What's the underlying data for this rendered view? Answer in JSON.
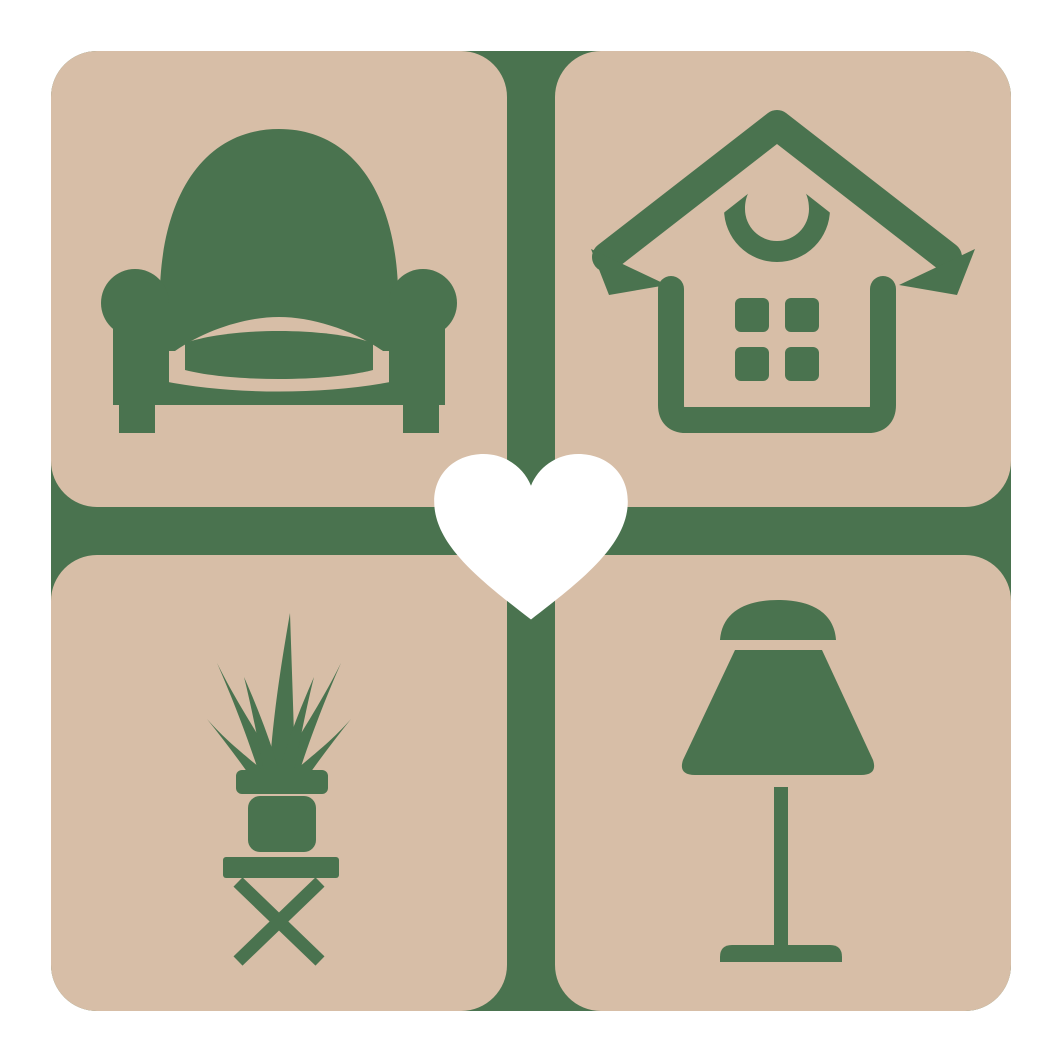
{
  "colors": {
    "green": "#4a734f",
    "beige": "#d7bea7",
    "white": "#ffffff",
    "background": "#ffffff"
  },
  "logo": {
    "tiles": [
      {
        "icon": "armchair-icon"
      },
      {
        "icon": "house-icon"
      },
      {
        "icon": "potted-plant-icon"
      },
      {
        "icon": "table-lamp-icon"
      }
    ],
    "center_icon": "heart-icon"
  }
}
